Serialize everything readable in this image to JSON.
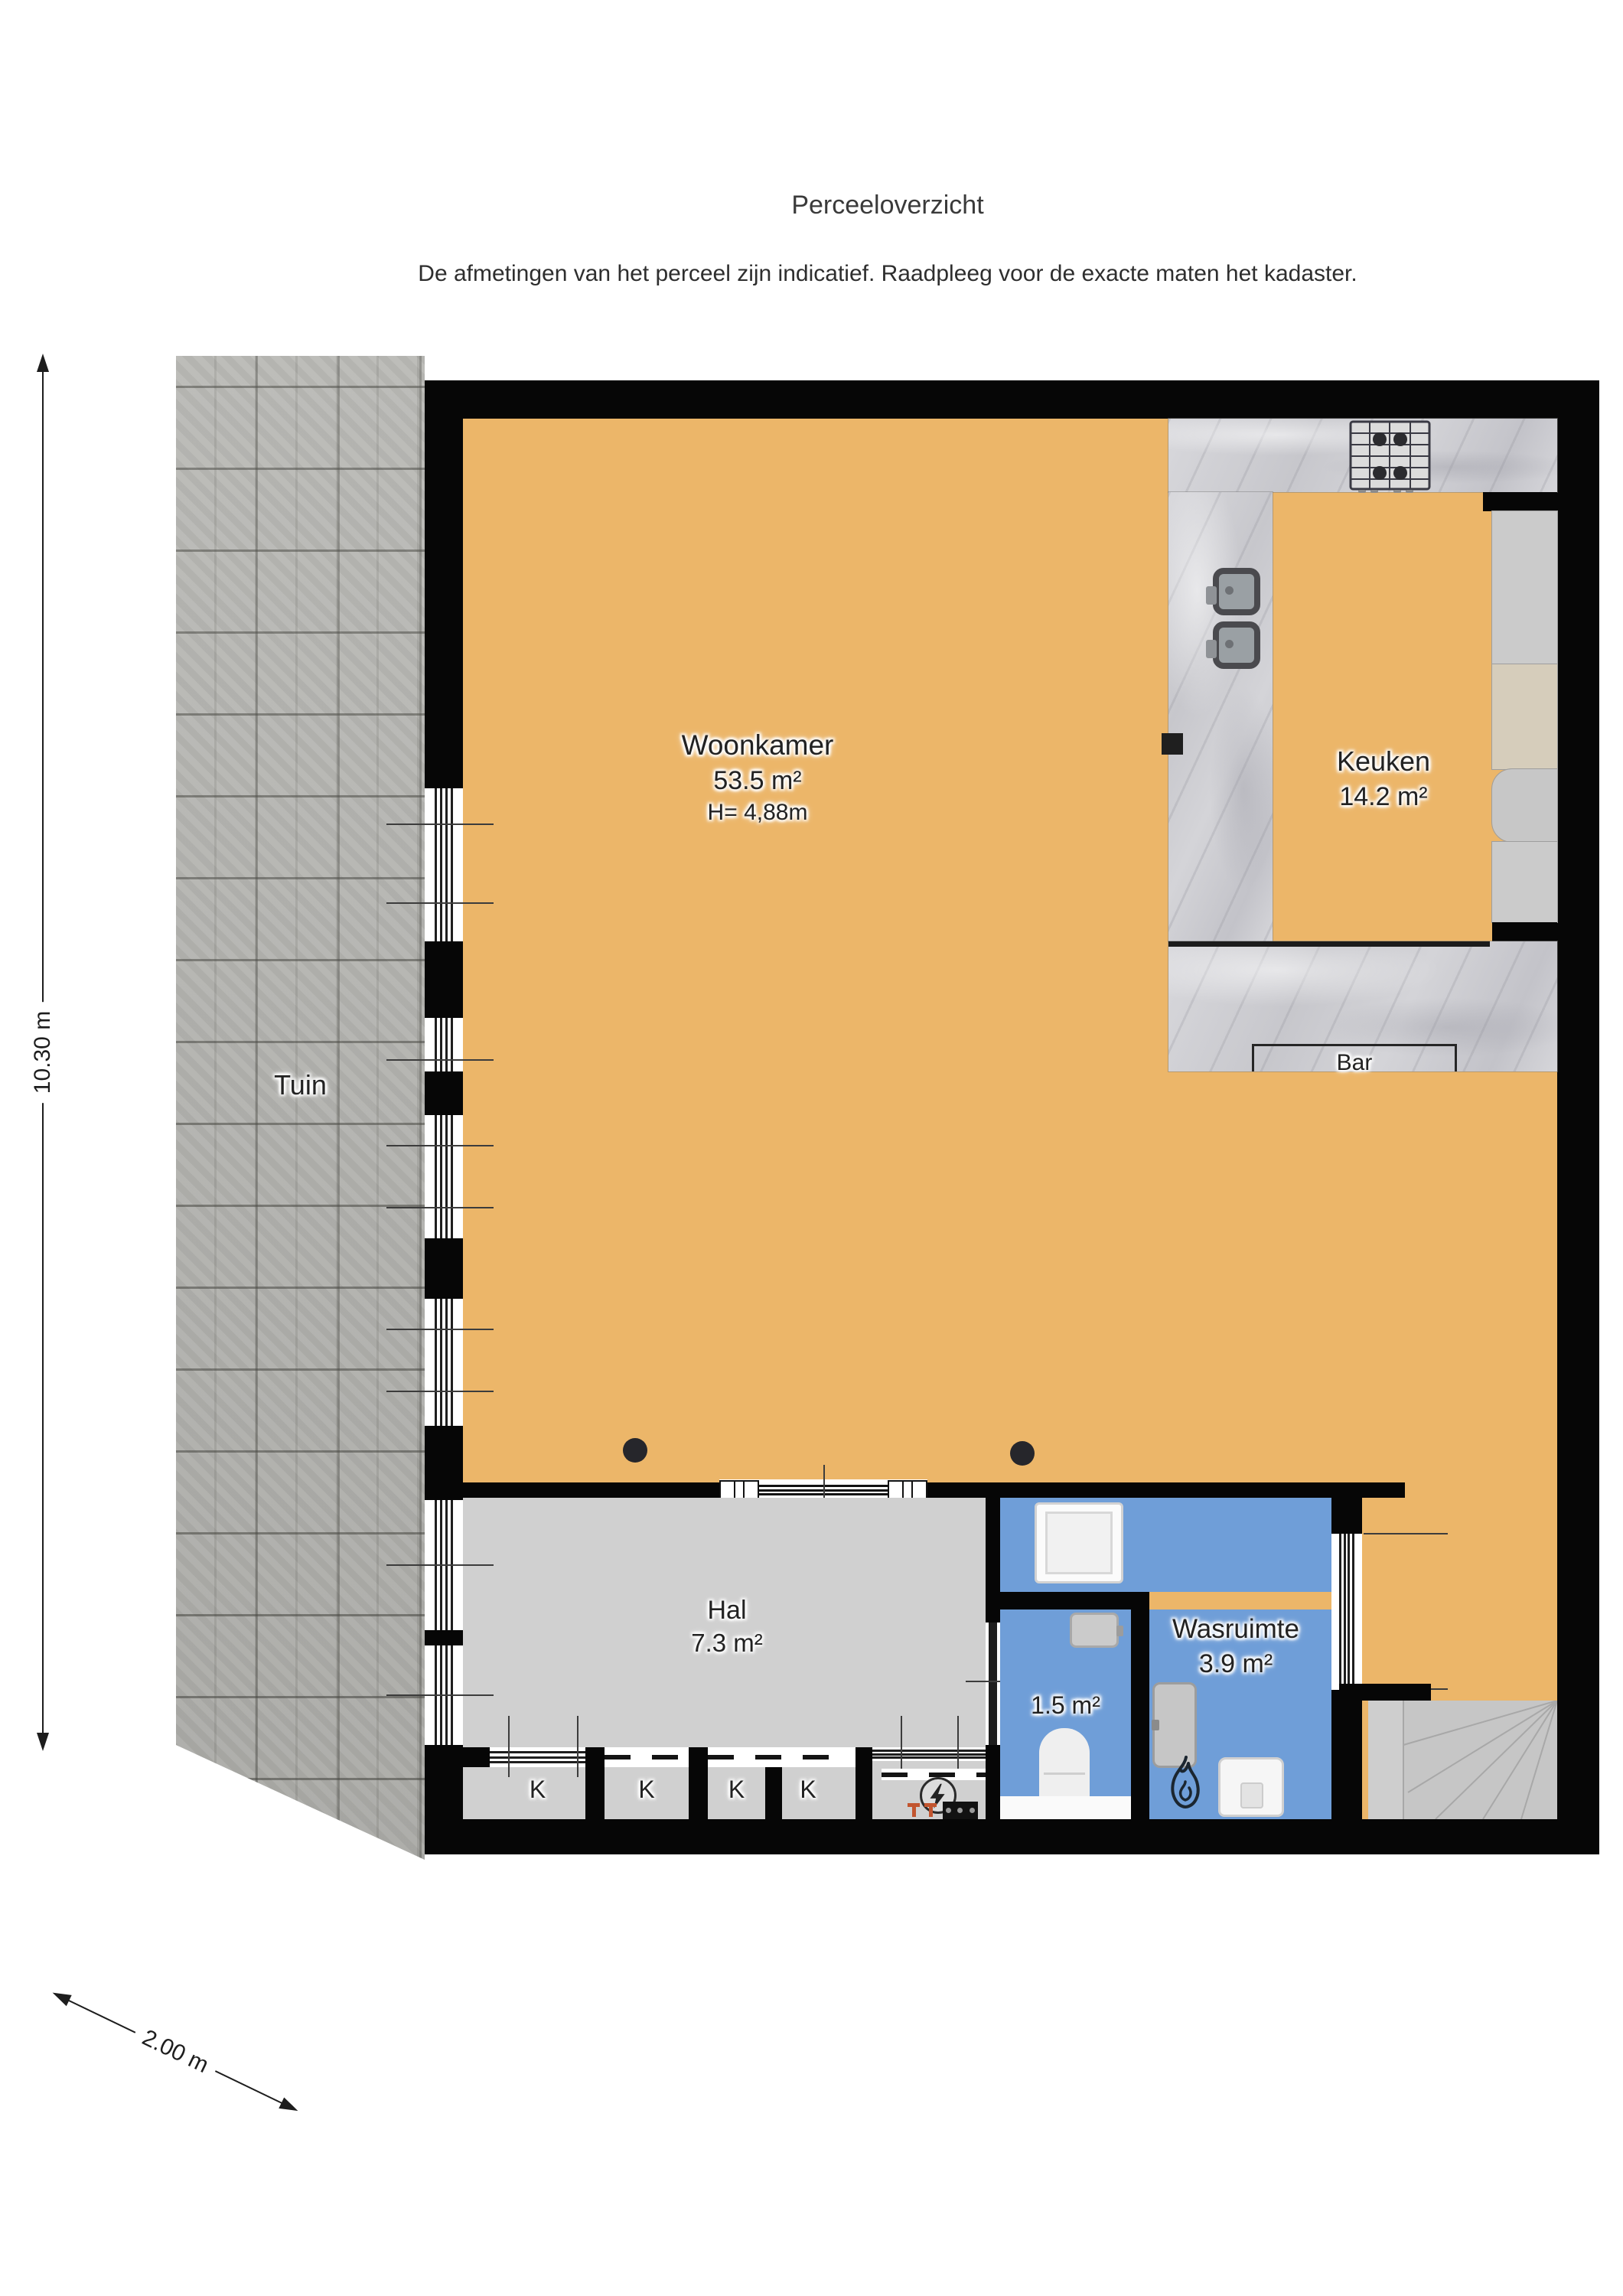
{
  "page": {
    "title": "Perceeloverzicht",
    "subtitle": "De afmetingen van het perceel zijn indicatief. Raadpleeg voor de exacte maten het kadaster."
  },
  "dimensions": {
    "height": "10.30 m",
    "width": "2.00 m"
  },
  "garden": {
    "label": "Tuin"
  },
  "rooms": {
    "woonkamer": {
      "name": "Woonkamer",
      "area": "53.5 m²",
      "ceiling": "H= 4,88m"
    },
    "keuken": {
      "name": "Keuken",
      "area": "14.2 m²"
    },
    "bar": {
      "name": "Bar"
    },
    "hal": {
      "name": "Hal",
      "area": "7.3 m²"
    },
    "wasruimte": {
      "name": "Wasruimte",
      "area": "3.9 m²"
    },
    "toilet": {
      "area": "1.5 m²"
    }
  },
  "closets": {
    "labels": [
      "K",
      "K",
      "K",
      "K"
    ]
  },
  "icons": {
    "stove": "4-burner-gas-hob",
    "kitchen_sink": "rounded-square-basin",
    "washing_machine": "front-loader-square",
    "toilet": "bowl-with-seat",
    "hand_basin": "small-rect-basin",
    "boiler": "white-rounded-unit",
    "flame": "flame-outline",
    "electric_meter": "circle-with-lightning-bolt",
    "radiator": "double-T-orange",
    "stairs": "fanned-steps"
  },
  "colors": {
    "floor_orange": "#ecb669",
    "floor_gray": "#d0d0d0",
    "wet_room_blue": "#6f9ed8",
    "wall_black": "#060606",
    "garden_tile": "#b5b5b1",
    "marble": "#d0d0d4",
    "cabinet_tan": "#d6cdbb",
    "radiator_orange": "#c2552f",
    "text_dark": "#222222"
  }
}
